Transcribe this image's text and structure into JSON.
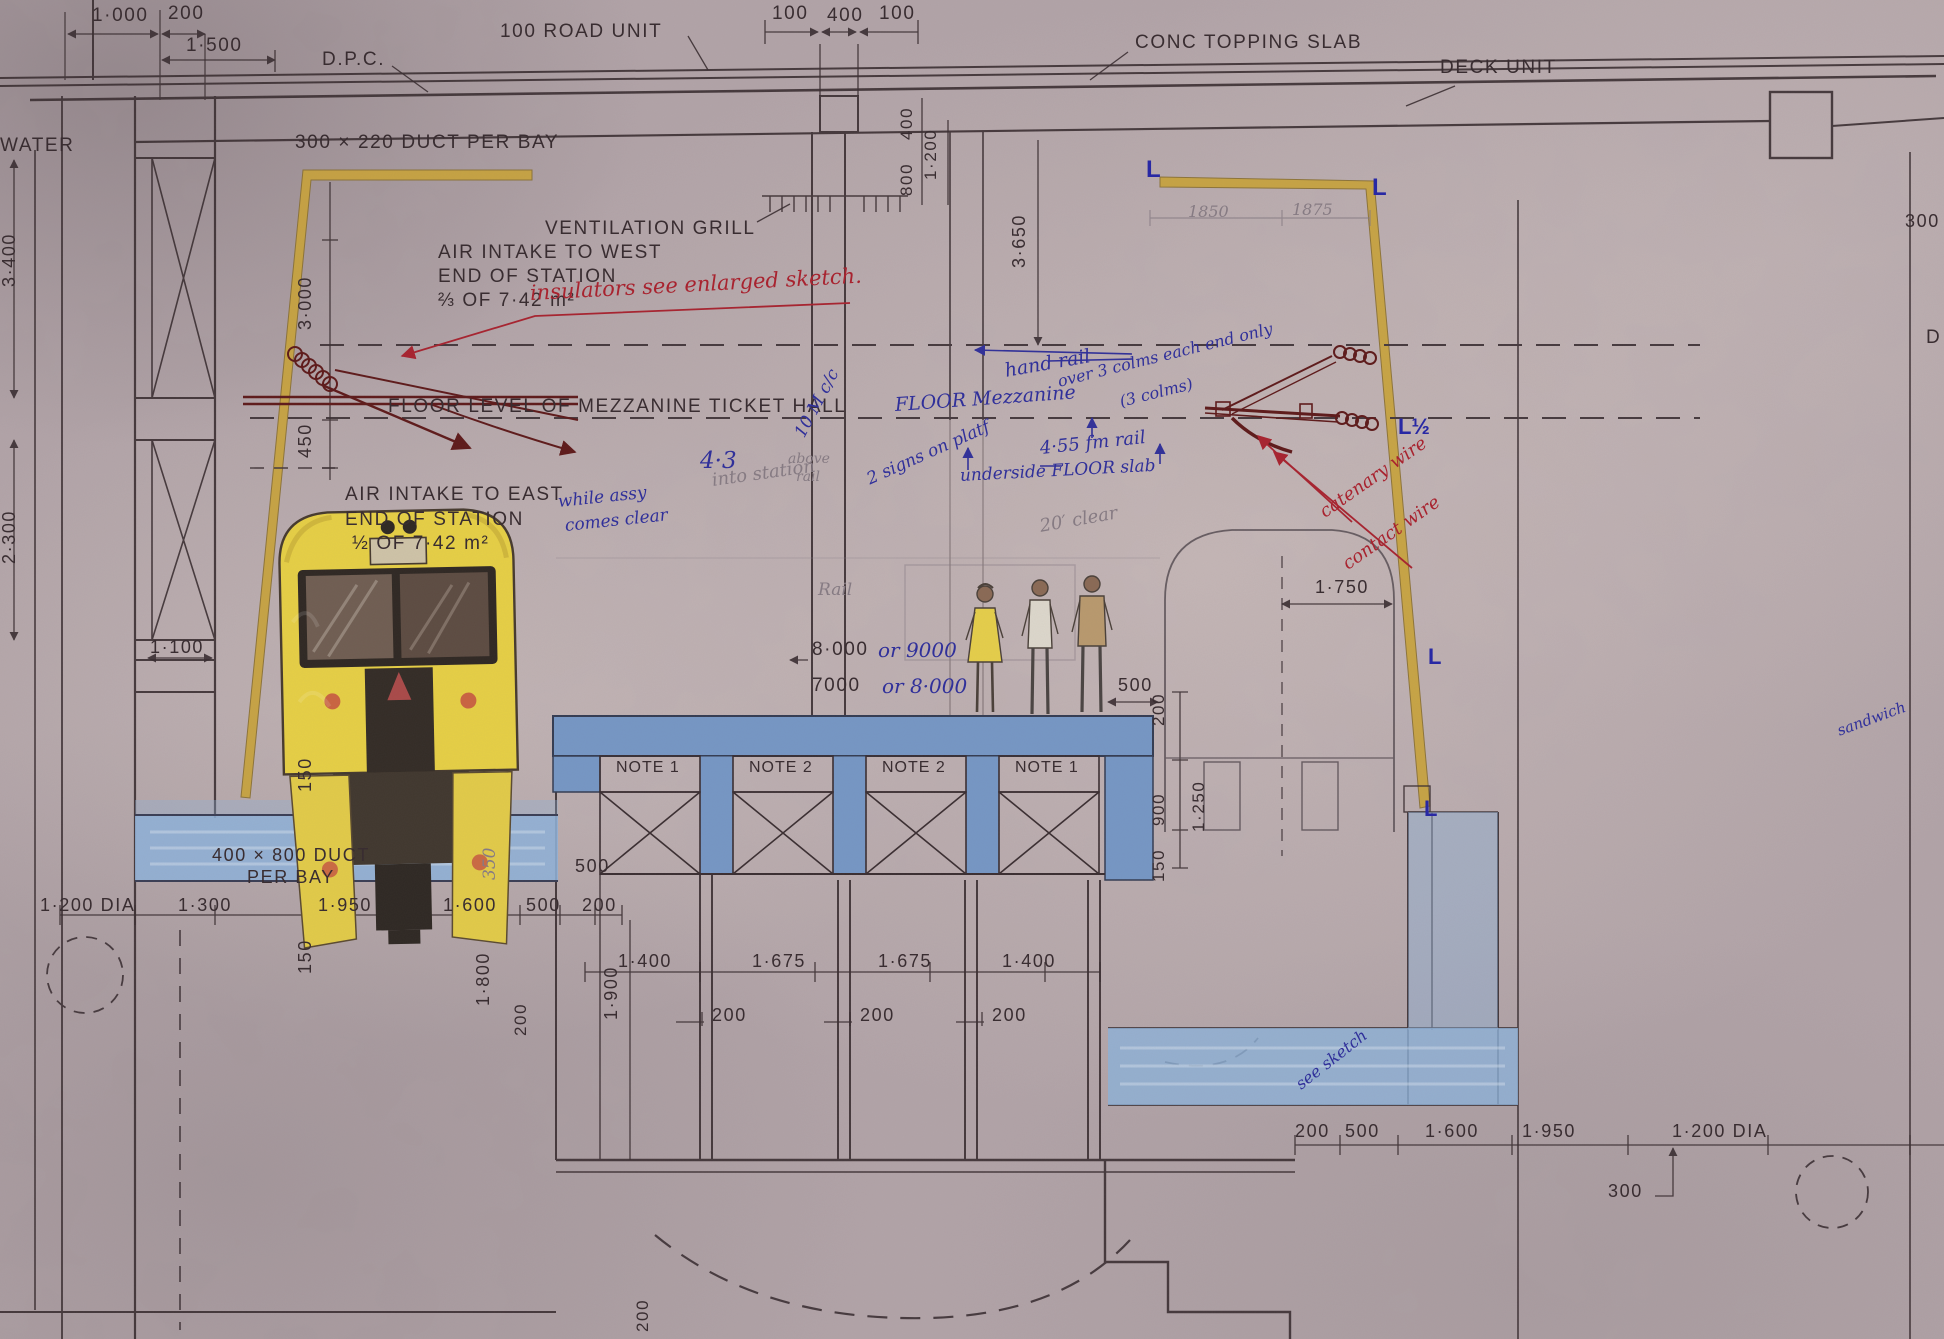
{
  "title": "Station cross-section engineering drawing with hand annotations",
  "colors": {
    "paper": "#b2a4a8",
    "ink": "#392d31",
    "blue_ink": "#30309a",
    "red_ink": "#a8232f",
    "pencil": "#867b83",
    "maroon": "#5e1a1a",
    "yellow_member": "#c9a43c",
    "train_yellow": "#e7d045",
    "wash_blue": "#8fb2d8",
    "platform_blue": "#7697c5"
  },
  "labels": [
    {
      "t": "1·000",
      "x": 92,
      "y": 6,
      "c": "ink",
      "s": 19
    },
    {
      "t": "200",
      "x": 168,
      "y": 4,
      "c": "ink",
      "s": 19
    },
    {
      "t": "1·500",
      "x": 186,
      "y": 36,
      "c": "ink",
      "s": 19
    },
    {
      "t": "D.P.C.",
      "x": 322,
      "y": 50,
      "c": "ink",
      "s": 19
    },
    {
      "t": "100  ROAD  UNIT",
      "x": 500,
      "y": 22,
      "c": "ink",
      "s": 19
    },
    {
      "t": "100",
      "x": 772,
      "y": 4,
      "c": "ink",
      "s": 19
    },
    {
      "t": "400",
      "x": 827,
      "y": 6,
      "c": "ink",
      "s": 19
    },
    {
      "t": "100",
      "x": 879,
      "y": 4,
      "c": "ink",
      "s": 19
    },
    {
      "t": "CONC  TOPPING  SLAB",
      "x": 1135,
      "y": 33,
      "c": "ink",
      "s": 19
    },
    {
      "t": "DECK  UNIT",
      "x": 1440,
      "y": 58,
      "c": "ink",
      "s": 19
    },
    {
      "t": "WATER",
      "x": 0,
      "y": 136,
      "c": "ink",
      "s": 19
    },
    {
      "t": "300 × 220  DUCT  PER  BAY",
      "x": 295,
      "y": 133,
      "c": "ink",
      "s": 19
    },
    {
      "t": "VENTILATION   GRILL",
      "x": 545,
      "y": 219,
      "c": "ink",
      "s": 19
    },
    {
      "t": "AIR  INTAKE  TO  WEST",
      "x": 438,
      "y": 243,
      "c": "ink",
      "s": 19
    },
    {
      "t": "END  OF  STATION",
      "x": 438,
      "y": 267,
      "c": "ink",
      "s": 19
    },
    {
      "t": "⅔  OF  7·42 m²",
      "x": 438,
      "y": 291,
      "c": "ink",
      "s": 19
    },
    {
      "t": "FLOOR  LEVEL  OF  MEZZANINE  TICKET  HALL",
      "x": 388,
      "y": 397,
      "c": "ink",
      "s": 19
    },
    {
      "t": "AIR  INTAKE  TO  EAST",
      "x": 345,
      "y": 485,
      "c": "ink",
      "s": 19
    },
    {
      "t": "END  OF  STATION",
      "x": 345,
      "y": 510,
      "c": "ink",
      "s": 19
    },
    {
      "t": "½  OF  7·42 m²",
      "x": 352,
      "y": 534,
      "c": "ink",
      "s": 19
    },
    {
      "t": "400",
      "x": 898,
      "y": 140,
      "c": "ink",
      "s": 17,
      "v": true
    },
    {
      "t": "800",
      "x": 898,
      "y": 196,
      "c": "ink",
      "s": 17,
      "v": true
    },
    {
      "t": "1·200",
      "x": 922,
      "y": 180,
      "c": "ink",
      "s": 17,
      "v": true
    },
    {
      "t": "3·650",
      "x": 1010,
      "y": 268,
      "c": "ink",
      "s": 18,
      "v": true
    },
    {
      "t": "3·400",
      "x": 0,
      "y": 287,
      "c": "ink",
      "s": 18,
      "v": true
    },
    {
      "t": "2·300",
      "x": 0,
      "y": 564,
      "c": "ink",
      "s": 18,
      "v": true
    },
    {
      "t": "3·000",
      "x": 296,
      "y": 330,
      "c": "ink",
      "s": 18,
      "v": true
    },
    {
      "t": "450",
      "x": 296,
      "y": 458,
      "c": "ink",
      "s": 18,
      "v": true
    },
    {
      "t": "1·100",
      "x": 150,
      "y": 638,
      "c": "ink",
      "s": 18
    },
    {
      "t": "150",
      "x": 296,
      "y": 792,
      "c": "ink",
      "s": 18,
      "v": true
    },
    {
      "t": "150",
      "x": 296,
      "y": 974,
      "c": "ink",
      "s": 18,
      "v": true
    },
    {
      "t": "1·800",
      "x": 474,
      "y": 1006,
      "c": "ink",
      "s": 18,
      "v": true
    },
    {
      "t": "350",
      "x": 482,
      "y": 880,
      "c": "pen",
      "s": 17,
      "v": true
    },
    {
      "t": "1·900",
      "x": 602,
      "y": 1020,
      "c": "ink",
      "s": 18,
      "v": true
    },
    {
      "t": "200",
      "x": 512,
      "y": 1036,
      "c": "ink",
      "s": 17,
      "v": true
    },
    {
      "t": "200",
      "x": 634,
      "y": 1332,
      "c": "ink",
      "s": 17,
      "v": true
    },
    {
      "t": "500",
      "x": 575,
      "y": 857,
      "c": "ink",
      "s": 18
    },
    {
      "t": "1·200 DIA",
      "x": 40,
      "y": 896,
      "c": "ink",
      "s": 18
    },
    {
      "t": "1·300",
      "x": 178,
      "y": 896,
      "c": "ink",
      "s": 18
    },
    {
      "t": "1·950",
      "x": 318,
      "y": 896,
      "c": "ink",
      "s": 18
    },
    {
      "t": "1·600",
      "x": 443,
      "y": 896,
      "c": "ink",
      "s": 18
    },
    {
      "t": "500",
      "x": 526,
      "y": 896,
      "c": "ink",
      "s": 18
    },
    {
      "t": "200",
      "x": 582,
      "y": 896,
      "c": "ink",
      "s": 18
    },
    {
      "t": "1·400",
      "x": 618,
      "y": 952,
      "c": "ink",
      "s": 18
    },
    {
      "t": "1·675",
      "x": 752,
      "y": 952,
      "c": "ink",
      "s": 18
    },
    {
      "t": "1·675",
      "x": 878,
      "y": 952,
      "c": "ink",
      "s": 18
    },
    {
      "t": "1·400",
      "x": 1002,
      "y": 952,
      "c": "ink",
      "s": 18
    },
    {
      "t": "200",
      "x": 712,
      "y": 1006,
      "c": "ink",
      "s": 18
    },
    {
      "t": "200",
      "x": 860,
      "y": 1006,
      "c": "ink",
      "s": 18
    },
    {
      "t": "200",
      "x": 992,
      "y": 1006,
      "c": "ink",
      "s": 18
    },
    {
      "t": "200",
      "x": 1295,
      "y": 1122,
      "c": "ink",
      "s": 18
    },
    {
      "t": "500",
      "x": 1345,
      "y": 1122,
      "c": "ink",
      "s": 18
    },
    {
      "t": "1·600",
      "x": 1425,
      "y": 1122,
      "c": "ink",
      "s": 18
    },
    {
      "t": "1·950",
      "x": 1522,
      "y": 1122,
      "c": "ink",
      "s": 18
    },
    {
      "t": "1·200 DIA",
      "x": 1672,
      "y": 1122,
      "c": "ink",
      "s": 18
    },
    {
      "t": "300",
      "x": 1608,
      "y": 1182,
      "c": "ink",
      "s": 18
    },
    {
      "t": "1·750",
      "x": 1315,
      "y": 578,
      "c": "ink",
      "s": 18
    },
    {
      "t": "500",
      "x": 1118,
      "y": 676,
      "c": "ink",
      "s": 18
    },
    {
      "t": "200",
      "x": 1150,
      "y": 726,
      "c": "ink",
      "s": 17,
      "v": true
    },
    {
      "t": "900",
      "x": 1150,
      "y": 826,
      "c": "ink",
      "s": 17,
      "v": true
    },
    {
      "t": "1·250",
      "x": 1190,
      "y": 832,
      "c": "ink",
      "s": 17,
      "v": true
    },
    {
      "t": "150",
      "x": 1150,
      "y": 882,
      "c": "ink",
      "s": 17,
      "v": true
    },
    {
      "t": "8·000",
      "x": 812,
      "y": 640,
      "c": "ink",
      "s": 19
    },
    {
      "t": "7000",
      "x": 812,
      "y": 676,
      "c": "ink",
      "s": 19
    },
    {
      "t": "NOTE 1",
      "x": 616,
      "y": 760,
      "c": "note",
      "s": 16
    },
    {
      "t": "NOTE 2",
      "x": 749,
      "y": 760,
      "c": "note",
      "s": 16
    },
    {
      "t": "NOTE 2",
      "x": 882,
      "y": 760,
      "c": "note",
      "s": 16
    },
    {
      "t": "NOTE 1",
      "x": 1015,
      "y": 760,
      "c": "note",
      "s": 16
    },
    {
      "t": "400 × 800  DUCT",
      "x": 212,
      "y": 846,
      "c": "ink",
      "s": 18
    },
    {
      "t": "PER  BAY",
      "x": 247,
      "y": 868,
      "c": "ink",
      "s": 18
    },
    {
      "t": "1850",
      "x": 1188,
      "y": 204,
      "c": "pen",
      "s": 16
    },
    {
      "t": "1875",
      "x": 1292,
      "y": 202,
      "c": "pen",
      "s": 16
    },
    {
      "t": "300",
      "x": 1905,
      "y": 212,
      "c": "ink",
      "s": 18
    },
    {
      "t": "D",
      "x": 1926,
      "y": 328,
      "c": "ink",
      "s": 19
    },
    {
      "t": "L",
      "x": 1146,
      "y": 158,
      "c": "bluem",
      "s": 24
    },
    {
      "t": "L",
      "x": 1372,
      "y": 176,
      "c": "bluem",
      "s": 24
    },
    {
      "t": "L½",
      "x": 1398,
      "y": 416,
      "c": "bluem",
      "s": 22
    },
    {
      "t": "L",
      "x": 1428,
      "y": 646,
      "c": "bluem",
      "s": 22
    },
    {
      "t": "L",
      "x": 1424,
      "y": 798,
      "c": "bluem",
      "s": 22
    },
    {
      "t": "insulators  see  enlarged  sketch.",
      "x": 530,
      "y": 283,
      "c": "red",
      "s": 21,
      "r": -3
    },
    {
      "t": "catenary wire",
      "x": 1322,
      "y": 505,
      "c": "red",
      "s": 18,
      "r": -35
    },
    {
      "t": "contact wire",
      "x": 1345,
      "y": 557,
      "c": "red",
      "s": 18,
      "r": -35
    },
    {
      "t": "hand rail",
      "x": 1005,
      "y": 362,
      "c": "blue",
      "s": 19,
      "r": -10
    },
    {
      "t": "over 3 colms each end only",
      "x": 1058,
      "y": 374,
      "c": "blue",
      "s": 16,
      "r": -14
    },
    {
      "t": "(3 colms)",
      "x": 1120,
      "y": 394,
      "c": "blue",
      "s": 16,
      "r": -14
    },
    {
      "t": "FLOOR  Mezzanine",
      "x": 895,
      "y": 396,
      "c": "blue",
      "s": 19,
      "r": -4
    },
    {
      "t": "10 M c/c",
      "x": 800,
      "y": 428,
      "c": "blue",
      "s": 17,
      "r": -62
    },
    {
      "t": "4·55 fm rail",
      "x": 1040,
      "y": 440,
      "c": "blue",
      "s": 18,
      "r": -6
    },
    {
      "t": "underside FLOOR slab",
      "x": 960,
      "y": 468,
      "c": "blue",
      "s": 17,
      "r": -3
    },
    {
      "t": "2 signs on platf",
      "x": 868,
      "y": 472,
      "c": "blue",
      "s": 17,
      "r": -24
    },
    {
      "t": "4·3",
      "x": 700,
      "y": 450,
      "c": "blue",
      "s": 23
    },
    {
      "t": "above",
      "x": 788,
      "y": 452,
      "c": "pen",
      "s": 14
    },
    {
      "t": "rail",
      "x": 796,
      "y": 470,
      "c": "pen",
      "s": 14
    },
    {
      "t": "while assy",
      "x": 558,
      "y": 494,
      "c": "blue",
      "s": 17,
      "r": -6
    },
    {
      "t": "comes clear",
      "x": 565,
      "y": 518,
      "c": "blue",
      "s": 17,
      "r": -6
    },
    {
      "t": "or 9000",
      "x": 878,
      "y": 640,
      "c": "blue",
      "s": 20
    },
    {
      "t": "or 8·000",
      "x": 882,
      "y": 676,
      "c": "blue",
      "s": 20
    },
    {
      "t": "sandwich",
      "x": 1838,
      "y": 724,
      "c": "blue",
      "s": 15,
      "r": -20
    },
    {
      "t": "see sketch",
      "x": 1298,
      "y": 1078,
      "c": "blue",
      "s": 16,
      "r": -38
    },
    {
      "t": "into station",
      "x": 712,
      "y": 472,
      "c": "pen",
      "s": 18,
      "r": -8
    },
    {
      "t": "Rail",
      "x": 818,
      "y": 582,
      "c": "pen",
      "s": 17
    },
    {
      "t": "20′ clear",
      "x": 1040,
      "y": 518,
      "c": "pen",
      "s": 18,
      "r": -10
    }
  ]
}
